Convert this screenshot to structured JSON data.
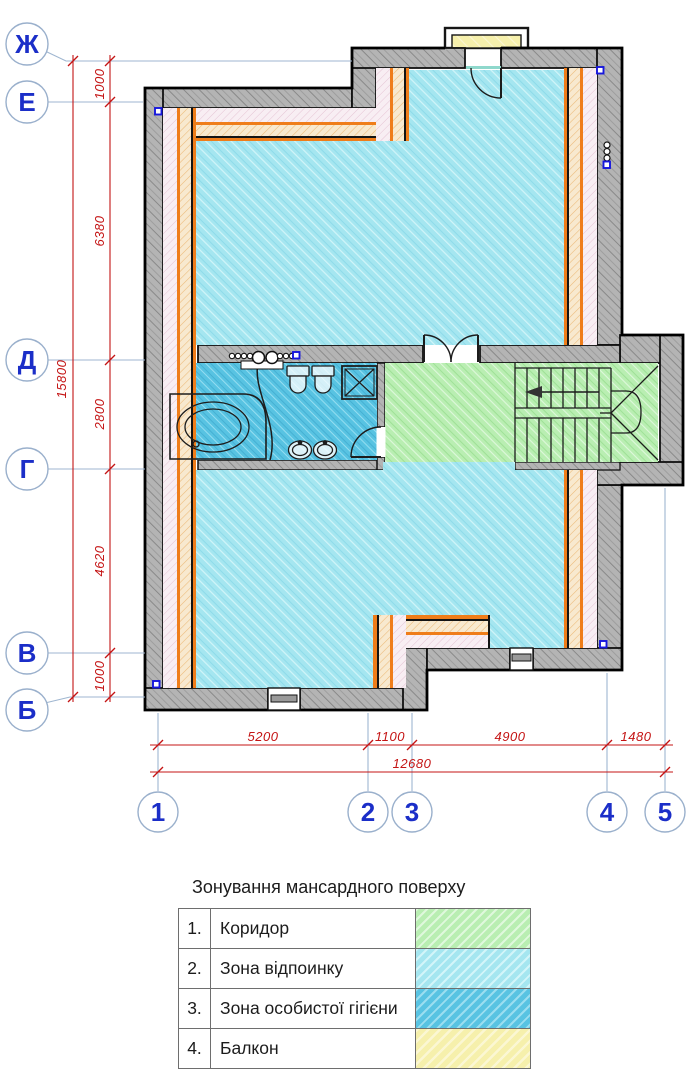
{
  "title": "Зонування мансардного поверху",
  "legend": {
    "rows": [
      {
        "num": "1.",
        "label": "Коридор",
        "zone": "corridor",
        "color": "#b9eeb2"
      },
      {
        "num": "2.",
        "label": "Зона відпоинку",
        "zone": "rest",
        "color": "#a5e6f0"
      },
      {
        "num": "3.",
        "label": "Зона особистої гігієни",
        "zone": "hygiene",
        "color": "#58c3e2"
      },
      {
        "num": "4.",
        "label": "Балкон",
        "zone": "balcony",
        "color": "#f6f0ac"
      }
    ]
  },
  "axes": {
    "rows": [
      {
        "label": "Ж"
      },
      {
        "label": "Е"
      },
      {
        "label": "Д"
      },
      {
        "label": "Г"
      },
      {
        "label": "В"
      },
      {
        "label": "Б"
      }
    ],
    "cols": [
      {
        "label": "1"
      },
      {
        "label": "2"
      },
      {
        "label": "3"
      },
      {
        "label": "4"
      },
      {
        "label": "5"
      }
    ]
  },
  "dimensions": {
    "overall_height": "15800",
    "height_chain": [
      "1000",
      "6380",
      "2800",
      "4620",
      "1000"
    ],
    "width_chain": [
      "5200",
      "1100",
      "4900",
      "1480"
    ],
    "overall_width": "12680"
  },
  "colors": {
    "dimension_red": "#c41414",
    "axis_blue": "#1b2ec8",
    "wall_gray": "#b4b4b4",
    "finish_orange": "#ef7d1a",
    "marker_blue": "#1717dd"
  }
}
